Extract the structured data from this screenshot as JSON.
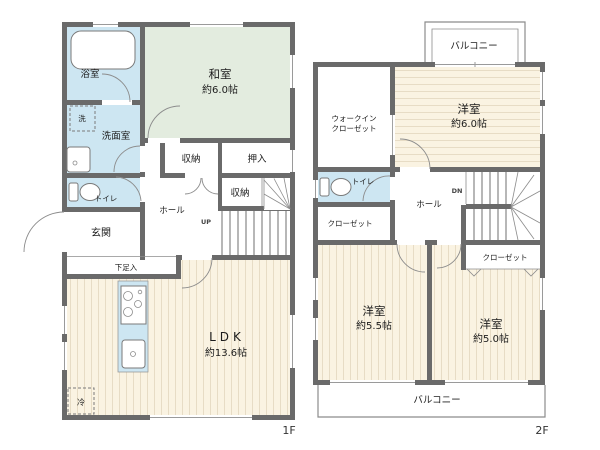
{
  "colors": {
    "wall": "#6a6a6a",
    "wet_room": "#cde6f2",
    "tatami": "#e3ecdf",
    "wood_floor": "#faf3e2",
    "wood_stripe": "#e7dcc5",
    "text": "#1c1c1c"
  },
  "floor1": {
    "floor_label": "1F",
    "rooms": {
      "tatami_name": "和室",
      "tatami_size": "約6.0帖",
      "ldk_name": "LDK",
      "ldk_size": "約13.6帖",
      "bath": "浴室",
      "washroom": "洗面室",
      "laundry": "洗",
      "toilet": "トイレ",
      "entrance": "玄関",
      "shoe_cabinet": "下足入",
      "hall": "ホール",
      "storage_upper": "収納",
      "oshiire": "押入",
      "storage_lower": "収納",
      "refrigerator": "冷",
      "stairs": "UP"
    }
  },
  "floor2": {
    "floor_label": "2F",
    "rooms": {
      "balcony_north": "バルコニー",
      "balcony_south": "バルコニー",
      "wic_line1": "ウォークイン",
      "wic_line2": "クローゼット",
      "toilet": "トイレ",
      "hall": "ホール",
      "stairs": "DN",
      "closet_west": "クローゼット",
      "closet_east": "クローゼット",
      "bedroom6_name": "洋室",
      "bedroom6_size": "約6.0帖",
      "bedroom55_name": "洋室",
      "bedroom55_size": "約5.5帖",
      "bedroom50_name": "洋室",
      "bedroom50_size": "約5.0帖"
    }
  }
}
